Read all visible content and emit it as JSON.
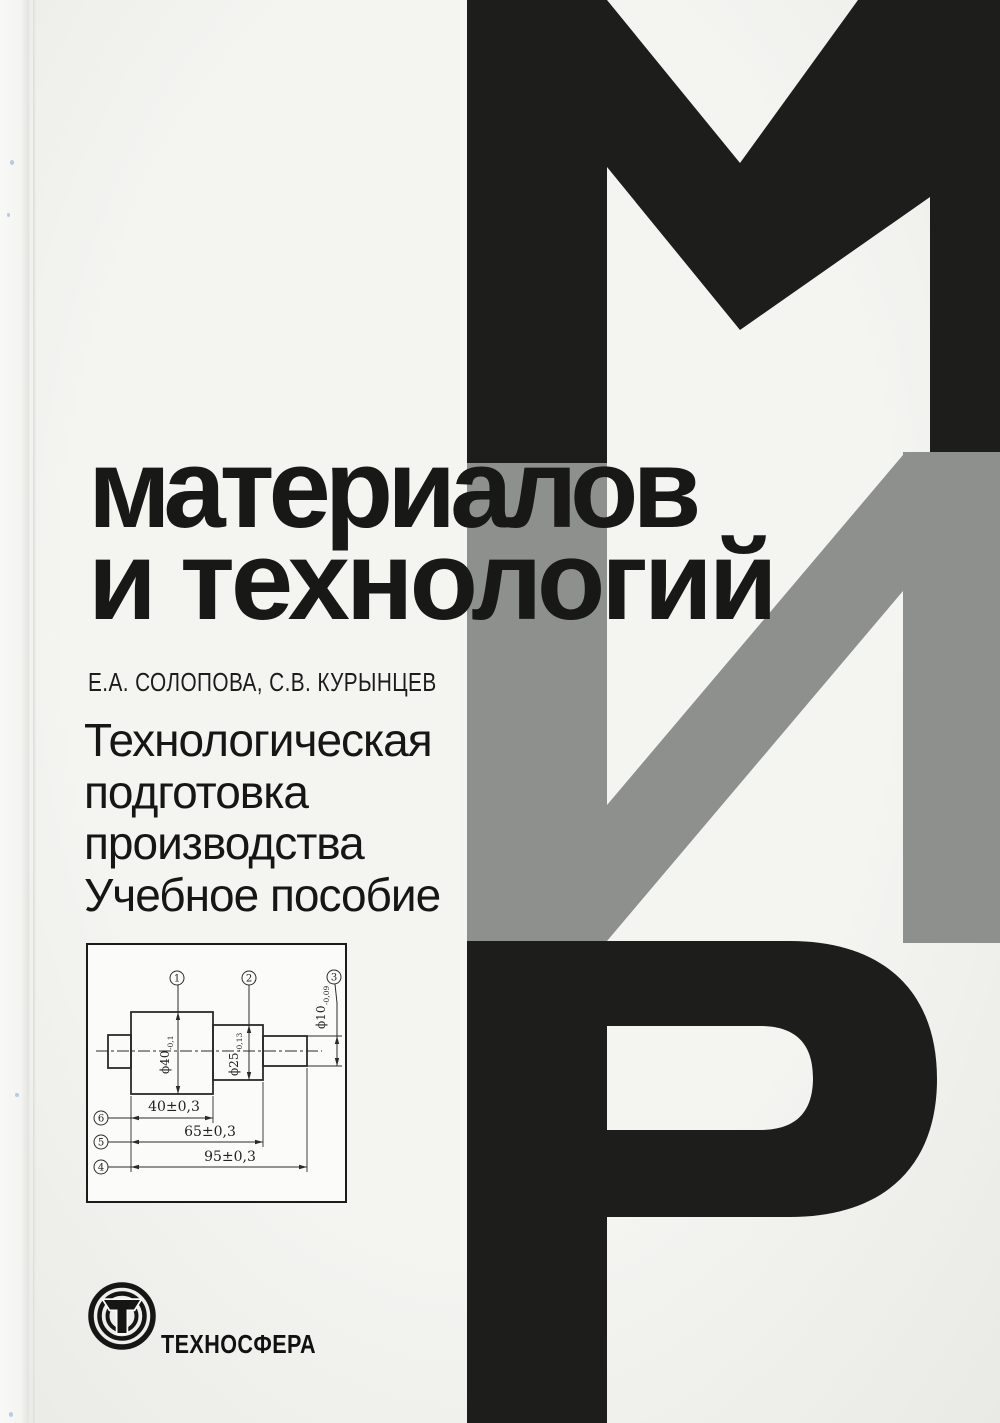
{
  "cover": {
    "series_line1": "материалов",
    "series_line2": "и технологий",
    "authors": "Е.А. СОЛОПОВА, С.В. КУРЫНЦЕВ",
    "title_lines": [
      "Технологическая",
      "подготовка",
      "производства",
      "Учебное пособие"
    ],
    "publisher": "ТЕХНОСФЕРА",
    "series_letters": [
      "М",
      "И",
      "Р"
    ],
    "colors": {
      "cover_bg": "#f1f1ee",
      "letter_black": "#1d1d1b",
      "letter_gray": "#8d908c",
      "text_black": "#181816"
    }
  },
  "drawing": {
    "datums": {
      "d1": "1",
      "d2": "2",
      "d3": "3",
      "d4": "4",
      "d5": "5",
      "d6": "6"
    },
    "dia": {
      "d40": {
        "main": "ϕ40",
        "tol": "-0,1"
      },
      "d25": {
        "main": "ϕ25",
        "tol": "-0,13"
      },
      "d10": {
        "main": "ϕ10",
        "tol": "-0,09"
      }
    },
    "lengths": {
      "l40": "40±0,3",
      "l65": "65±0,3",
      "l95": "95±0,3"
    }
  }
}
